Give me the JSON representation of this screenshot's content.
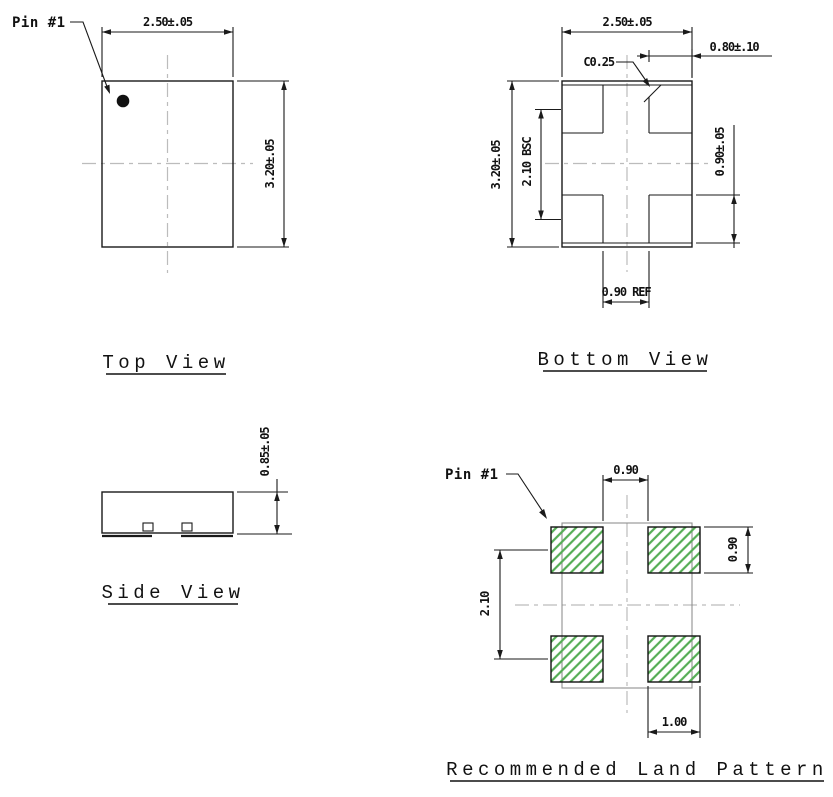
{
  "drawing": {
    "views": {
      "top_view": {
        "title": "Top View",
        "pin_label": "Pin #1",
        "width_dim": "2.50±.05",
        "height_dim": "3.20±.05"
      },
      "bottom_view": {
        "title": "Bottom View",
        "width_dim": "2.50±.05",
        "pad_width_dim": "0.80±.10",
        "chamfer_dim": "C0.25",
        "height_dim": "3.20±.05",
        "pad_pitch_dim": "2.10 BSC",
        "pad_height_dim": "0.90±.05",
        "pad_gap_dim": "0.90 REF"
      },
      "side_view": {
        "title": "Side View",
        "thickness_dim": "0.85±.05"
      },
      "land_pattern": {
        "title": "Recommended Land Pattern",
        "pin_label": "Pin #1",
        "pad_gap_dim": "0.90",
        "pad_height_dim": "0.90",
        "pad_pitch_dim": "2.10",
        "pad_width_dim": "1.00"
      }
    },
    "colors": {
      "line": "#1a1a1a",
      "centerline": "#bcbcbc",
      "ghost_outline": "#8f8f8f",
      "pad_hatch_green": "#55ad55",
      "background": "#ffffff"
    }
  }
}
